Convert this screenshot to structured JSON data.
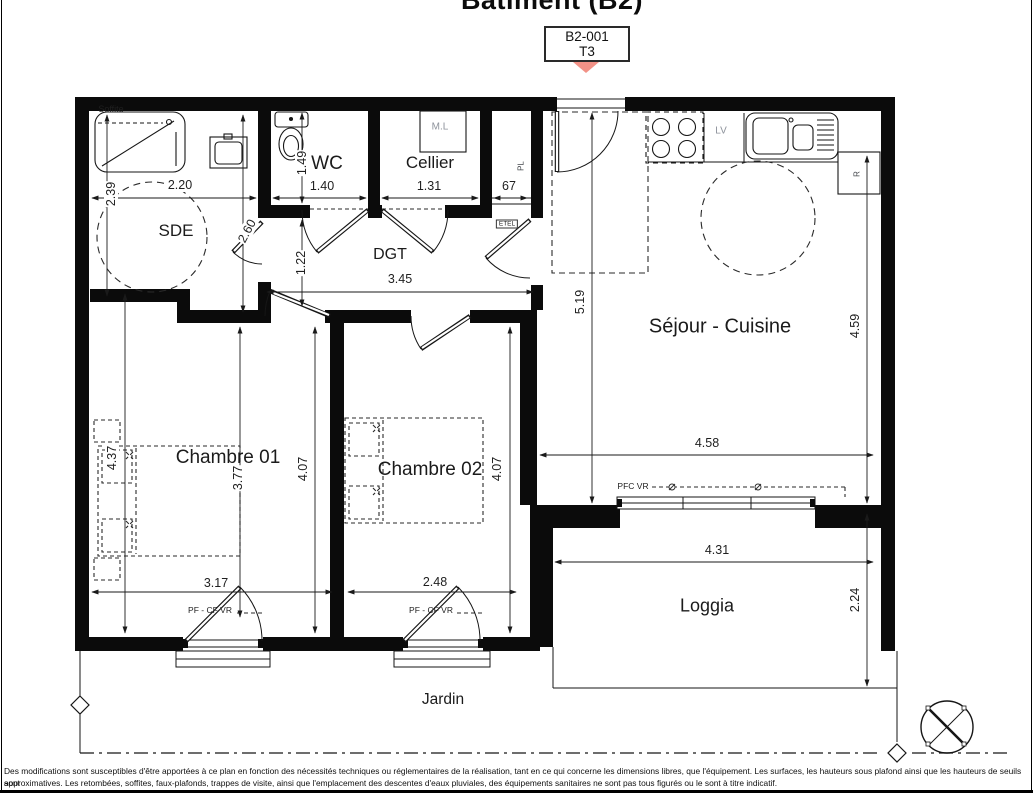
{
  "header": {
    "title": "Bâtiment (B2)",
    "unit_code": "B2-001",
    "unit_type": "T3"
  },
  "colors": {
    "marker": "#f29287",
    "ink": "#151515",
    "gray_label": "#8d929b"
  },
  "rooms": [
    {
      "label": "SDE",
      "x": 176,
      "y": 231,
      "fs": 17
    },
    {
      "label": "WC",
      "x": 327,
      "y": 164,
      "fs": 19
    },
    {
      "label": "Cellier",
      "x": 430,
      "y": 163,
      "fs": 17
    },
    {
      "label": "DGT",
      "x": 390,
      "y": 255,
      "fs": 16
    },
    {
      "label": "Séjour - Cuisine",
      "x": 720,
      "y": 327,
      "fs": 20
    },
    {
      "label": "Chambre 01",
      "x": 228,
      "y": 458,
      "fs": 19
    },
    {
      "label": "Chambre 02",
      "x": 430,
      "y": 470,
      "fs": 19
    },
    {
      "label": "Loggia",
      "x": 707,
      "y": 606,
      "fs": 18
    },
    {
      "label": "Jardin",
      "x": 443,
      "y": 700,
      "fs": 15.5
    }
  ],
  "dims": [
    {
      "label": "2.39",
      "x": 111,
      "y": 194,
      "rot": -90
    },
    {
      "label": "2.20",
      "x": 180,
      "y": 185
    },
    {
      "label": "2.60",
      "x": 247,
      "y": 231,
      "rot": -62
    },
    {
      "label": "1.49",
      "x": 302,
      "y": 163,
      "rot": -90
    },
    {
      "label": "1.40",
      "x": 322,
      "y": 186
    },
    {
      "label": "1.31",
      "x": 429,
      "y": 186
    },
    {
      "label": "67",
      "x": 509,
      "y": 186
    },
    {
      "label": "1.22",
      "x": 301,
      "y": 263,
      "rot": -90
    },
    {
      "label": "3.45",
      "x": 400,
      "y": 279
    },
    {
      "label": "5.19",
      "x": 580,
      "y": 302,
      "rot": -90
    },
    {
      "label": "4.59",
      "x": 855,
      "y": 326,
      "rot": -90
    },
    {
      "label": "4.58",
      "x": 707,
      "y": 443
    },
    {
      "label": "4.37",
      "x": 112,
      "y": 458,
      "rot": -90
    },
    {
      "label": "3.77",
      "x": 238,
      "y": 478,
      "rot": -90
    },
    {
      "label": "4.07",
      "x": 303,
      "y": 469,
      "rot": -90
    },
    {
      "label": "4.07",
      "x": 497,
      "y": 469,
      "rot": -90
    },
    {
      "label": "3.17",
      "x": 216,
      "y": 583
    },
    {
      "label": "2.48",
      "x": 435,
      "y": 582
    },
    {
      "label": "4.31",
      "x": 717,
      "y": 550
    },
    {
      "label": "2.24",
      "x": 855,
      "y": 600,
      "rot": -90
    }
  ],
  "tags": [
    {
      "label": "Soffite",
      "x": 111,
      "y": 109,
      "fs": 9
    },
    {
      "label": "M.L",
      "x": 440,
      "y": 127,
      "fs": 10,
      "c": "#8d929b"
    },
    {
      "label": "PL",
      "x": 521,
      "y": 166,
      "fs": 8,
      "rot": -90,
      "c": "#45484d"
    },
    {
      "label": "ETEL",
      "x": 507,
      "y": 224,
      "fs": 6.5,
      "boxed": true
    },
    {
      "label": "LV",
      "x": 721,
      "y": 131,
      "fs": 10,
      "c": "#8d929b"
    },
    {
      "label": "R",
      "x": 857,
      "y": 174,
      "fs": 8,
      "rot": -90,
      "c": "#45484d"
    },
    {
      "label": "PFC VR",
      "x": 633,
      "y": 486,
      "fs": 8.5
    },
    {
      "label": "PF - CF VR",
      "x": 210,
      "y": 610,
      "fs": 8.5
    },
    {
      "label": "PF - CF VR",
      "x": 431,
      "y": 610,
      "fs": 8.5
    }
  ],
  "footer": {
    "line1": "Des modifications sont susceptibles d'être apportées à ce plan en fonction des nécessités techniques ou réglementaires de la réalisation, tant en ce qui concerne les dimensions libres, que l'équipement. Les surfaces, les hauteurs sous plafond ainsi que les hauteurs de seuils sont",
    "line2": "approximatives. Les retombées, soffites, faux-plafonds, trappes de visite, ainsi que l'emplacement des descentes d'eaux pluviales, des équipements sanitaires ne sont pas tous figurés ou le sont à titre indicatif."
  }
}
